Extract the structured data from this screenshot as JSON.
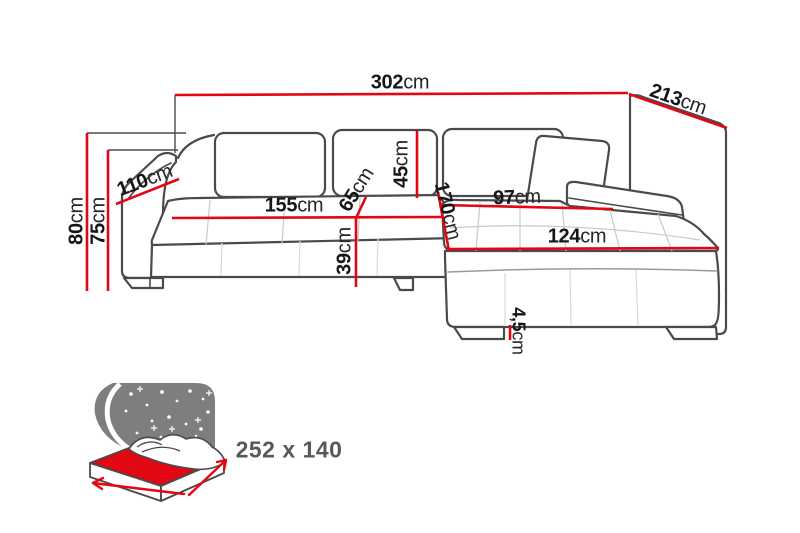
{
  "diagram": {
    "type": "corner-sofa-dimension-diagram"
  },
  "dim": {
    "total_width": {
      "v": "302",
      "u": "cm"
    },
    "total_depth": {
      "v": "213",
      "u": "cm"
    },
    "total_height": {
      "v": "80",
      "u": "cm"
    },
    "armrest_height": {
      "v": "75",
      "u": "cm"
    },
    "armrest_depth": {
      "v": "110",
      "u": "cm"
    },
    "seat_width": {
      "v": "155",
      "u": "cm"
    },
    "backrest_height": {
      "v": "45",
      "u": "cm"
    },
    "seat_depth": {
      "v": "65",
      "u": "cm"
    },
    "seat_height": {
      "v": "39",
      "u": "cm"
    },
    "chaise_length": {
      "v": "170",
      "u": "cm"
    },
    "chaise_seat_width": {
      "v": "97",
      "u": "cm"
    },
    "chaise_front_width": {
      "v": "124",
      "u": "cm"
    },
    "leg_height": {
      "v": "4,5",
      "u": "cm"
    }
  },
  "sleeping_area": {
    "size": "252 x 140"
  },
  "colors": {
    "dimension_red": "#e30613",
    "outline_gray": "#4a4a4c",
    "icon_gray": "#7e7e80",
    "text_dark": "#161616",
    "bed_text_gray": "#58585a"
  }
}
